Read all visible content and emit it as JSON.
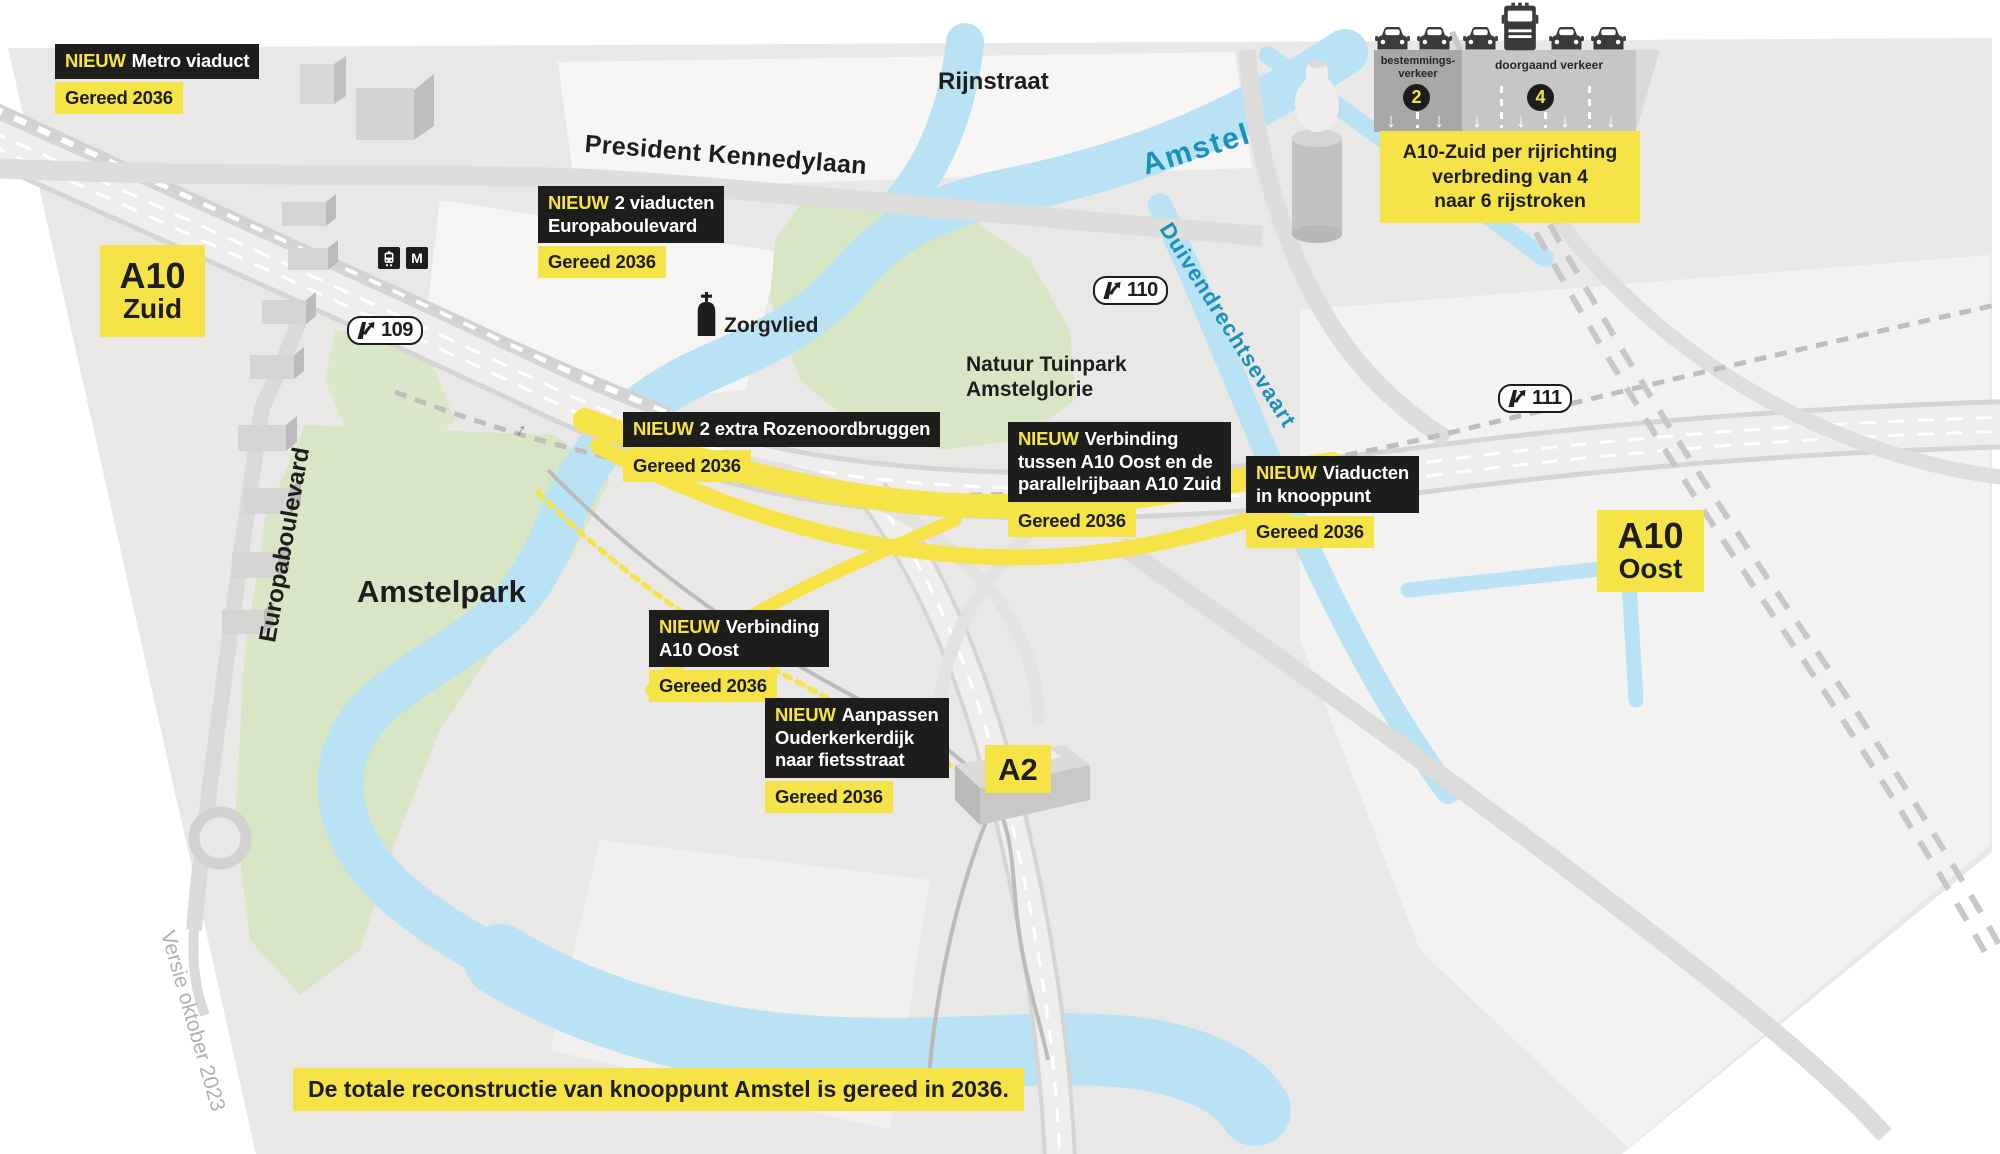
{
  "meta": {
    "version_note": "Versie oktober 2023"
  },
  "banner": {
    "text": "De totale reconstructie van knooppunt Amstel is gereed in 2036."
  },
  "road_badges": {
    "a10_zuid": {
      "line1": "A10",
      "line2": "Zuid"
    },
    "a10_oost": {
      "line1": "A10",
      "line2": "Oost"
    },
    "a2": {
      "line1": "A2"
    }
  },
  "exits": {
    "e109": "109",
    "e110": "110",
    "e111": "111"
  },
  "places": {
    "amstelpark": "Amstelpark",
    "tuinpark": "Natuur Tuinpark\nAmstelglorie",
    "zorgvlied": "Zorgvlied",
    "rijnstraat": "Rijnstraat",
    "kennedylaan": "President Kennedylaan",
    "europaboulevard": "Europaboulevard",
    "amstel": "Amstel",
    "duivendrechtsevaart": "Duivendrechtsevaart",
    "metro_m": "M"
  },
  "projects": {
    "metro_viaduct": {
      "tag": "NIEUW",
      "text": "Metro viaduct",
      "status": "Gereed 2036"
    },
    "viaducten_europaboulevard": {
      "tag": "NIEUW",
      "text": "2 viaducten\nEuropaboulevard",
      "status": "Gereed 2036"
    },
    "rozenoordbruggen": {
      "tag": "NIEUW",
      "text": "2 extra Rozenoordbruggen",
      "status": "Gereed 2036"
    },
    "verbinding_parallelrijbaan": {
      "tag": "NIEUW",
      "text": "Verbinding\ntussen A10 Oost en de\nparallelrijbaan A10 Zuid",
      "status": "Gereed 2036"
    },
    "viaducten_knooppunt": {
      "tag": "NIEUW",
      "text": "Viaducten\nin knooppunt",
      "status": "Gereed 2036"
    },
    "verbinding_a10_oost": {
      "tag": "NIEUW",
      "text": "Verbinding\nA10 Oost",
      "status": "Gereed 2036"
    },
    "ouderkerkerdijk": {
      "tag": "NIEUW",
      "text": "Aanpassen\nOuderkerkerdijk\nnaar fietsstraat",
      "status": "Gereed 2036"
    }
  },
  "lane_diagram": {
    "left_label": "bestemmings-\nverkeer",
    "left_lanes": "2",
    "right_label": "doorgaand verkeer",
    "right_lanes": "4",
    "arrow": "↓",
    "caption": "A10-Zuid per rijrichting\nverbreding van 4\nnaar 6 rijstroken"
  },
  "colors": {
    "accent_yellow": "#f5e348",
    "label_black": "#1d1d1b",
    "water_blue": "#b9e2f4",
    "water_text": "#1a90bc",
    "park_green": "#d9e6c6"
  }
}
